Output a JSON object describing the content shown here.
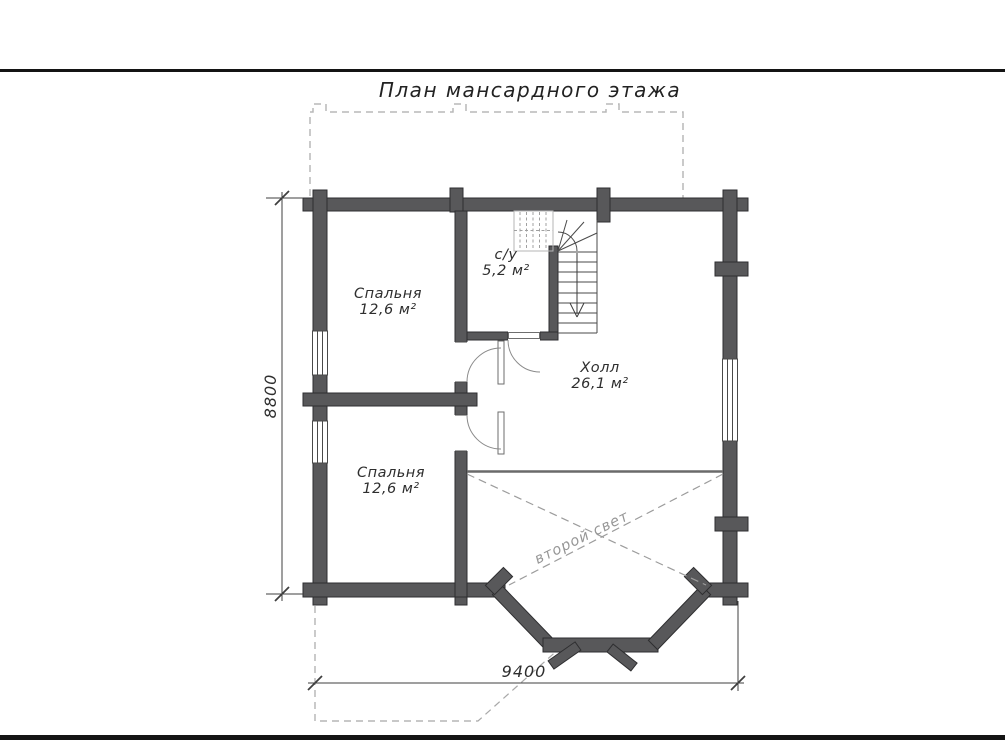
{
  "sheet": {
    "title": "План мансардного этажа"
  },
  "rooms": [
    {
      "id": "bedroom-1",
      "name": "Спальня",
      "area": "12,6 м²"
    },
    {
      "id": "bathroom",
      "name": "с/у",
      "area": "5,2 м²"
    },
    {
      "id": "hall",
      "name": "Холл",
      "area": "26,1 м²"
    },
    {
      "id": "bedroom-2",
      "name": "Спальня",
      "area": "12,6 м²"
    }
  ],
  "annotations": {
    "void_label": "второй свет"
  },
  "dimensions": {
    "vertical": "8800",
    "horizontal": "9400"
  },
  "legend": {
    "stair_direction": "down-arrow"
  },
  "colors": {
    "wall_fill": "#58585a",
    "wall_outline": "#2e2e30",
    "thin_line": "#3f3f3f",
    "dashed_outline": "#b8b8b8",
    "dashed_void": "#9c9c9c",
    "text": "#2e2e2e",
    "muted_text": "#969696",
    "sheet_border": "#141414"
  }
}
